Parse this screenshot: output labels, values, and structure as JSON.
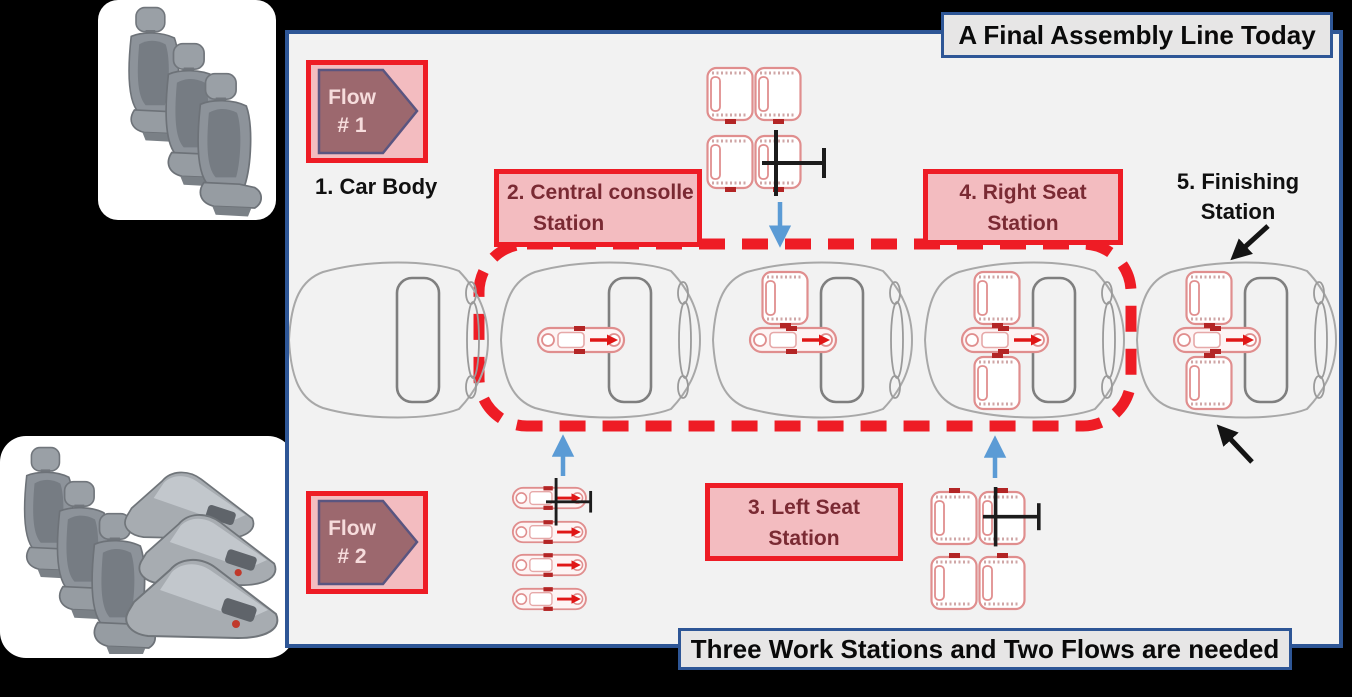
{
  "header": {
    "title": "A Final Assembly Line Today"
  },
  "footer": {
    "banner": "Three Work Stations and Two Flows are needed"
  },
  "flows": [
    {
      "line1": "Flow",
      "line2": "# 1"
    },
    {
      "line1": "Flow",
      "line2": "# 2"
    }
  ],
  "labels": {
    "car_body": "1. Car Body"
  },
  "stations": {
    "central": {
      "line1": "2. Central consolle",
      "line2": "Station"
    },
    "left": {
      "line1": "3. Left Seat",
      "line2": "Station"
    },
    "right": {
      "line1": "4. Right Seat",
      "line2": "Station"
    },
    "finishing": {
      "line1": "5. Finishing",
      "line2": "Station"
    }
  },
  "icons": {
    "flow_arrow": "pentagon-right-arrow",
    "supply_arrow": "blue-arrow",
    "pointer_arrow": "black-arrow",
    "handling_tool": "t-bar-manipulator",
    "seat_top_view": "seat-outline",
    "console_top_view": "console-outline",
    "car_top_view": "car-body-outline",
    "seat_photo": "car-seat",
    "console_photo": "center-console"
  },
  "colors": {
    "background": "#000000",
    "panel_bg": "#f2f2f2",
    "panel_border": "#2e5696",
    "box_bg": "#e7e6e6",
    "accent_red": "#ee1c25",
    "station_pink": "#f3bcc0",
    "station_text": "#7a2a33",
    "flow_fill": "#9c686e",
    "flow_border": "#5a5580",
    "arrow_blue": "#5b9bd5",
    "car_outline": "#a8a8a8",
    "seat_outline": "#e08e8e",
    "accent_dark_red": "#b32525"
  }
}
